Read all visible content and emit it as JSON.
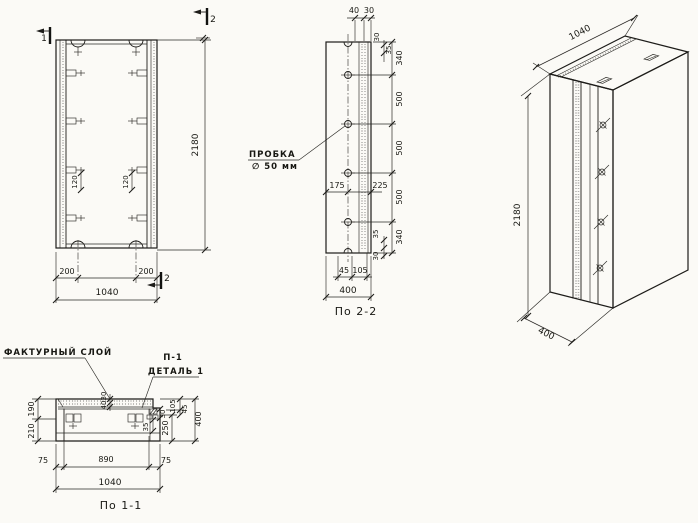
{
  "front_view": {
    "section_mark_1": "1",
    "section_mark_2": "2",
    "dim_height": "2180",
    "dim_loop_offset_left": "200",
    "dim_loop_offset_right": "200",
    "dim_width_total": "1040",
    "dim_lug_left": "120",
    "dim_lug_right": "120"
  },
  "section_2_2": {
    "caption": "По 2-2",
    "plug_label_line1": "ПРОБКА",
    "plug_label_line2": "∅ 50 мм",
    "dim_layer_40": "40",
    "dim_layer_30": "30",
    "dim_edge_top_30": "30",
    "dim_edge_top_35": "35",
    "chain_dims": [
      "340",
      "500",
      "500",
      "500",
      "340"
    ],
    "dim_mid_175": "175",
    "dim_mid_225": "225",
    "dim_edge_bottom_35": "35",
    "dim_edge_bottom_30": "30",
    "dim_bottom_45": "45",
    "dim_bottom_105": "105",
    "dim_width_total": "400"
  },
  "isometric_view": {
    "dim_width": "1040",
    "dim_height": "2180",
    "dim_depth": "400"
  },
  "section_1_1": {
    "caption": "По 1-1",
    "label_facing_layer": "ФАКТУРНЫЙ СЛОЙ",
    "label_detail_ref": "П-1",
    "label_detail_name": "ДЕТАЛЬ 1",
    "dim_left_190": "190",
    "dim_left_210": "210",
    "dim_layer_30": "30",
    "dim_layer_40": "40",
    "dim_right_105": "105",
    "dim_right_45": "45",
    "dim_right_250": "250",
    "dim_right_total": "400",
    "dim_detail_30": "30",
    "dim_detail_35": "35",
    "dim_bottom_75_left": "75",
    "dim_bottom_890": "890",
    "dim_bottom_75_right": "75",
    "dim_bottom_total": "1040"
  }
}
